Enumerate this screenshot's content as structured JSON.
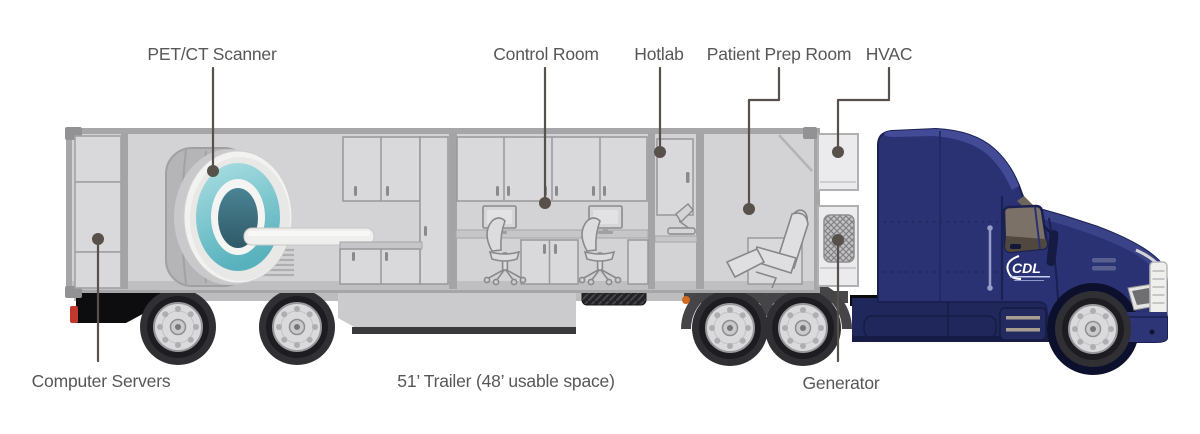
{
  "labels": {
    "pet_ct_scanner": "PET/CT Scanner",
    "control_room": "Control Room",
    "hotlab": "Hotlab",
    "patient_prep_room": "Patient Prep Room",
    "hvac": "HVAC",
    "computer_servers": "Computer Servers",
    "trailer_spec": "51’ Trailer (48’ usable space)",
    "generator": "Generator"
  },
  "truck": {
    "logo_text": "CDL"
  },
  "colors": {
    "label_text": "#575757",
    "callout": "#57504b",
    "trailer_body": "#d3d3d5",
    "trailer_outline": "#a6a6a8",
    "interior_wall": "#a4a4a6",
    "cabinet": "#d9d9db",
    "scanner_teal": "#58b2bd",
    "scanner_teal_light": "#abdfe3",
    "scanner_bore": "#2f5968",
    "truck_body": "#2b3274",
    "truck_shadow": "#1a2152",
    "truck_highlight": "#434b97",
    "window_glass": "#7b7166",
    "tire": "#303034",
    "wheel_rim": "#dadadc",
    "taillight_red": "#c0392b",
    "marker_orange": "#cf6a1f",
    "logo_white": "#ffffff"
  }
}
